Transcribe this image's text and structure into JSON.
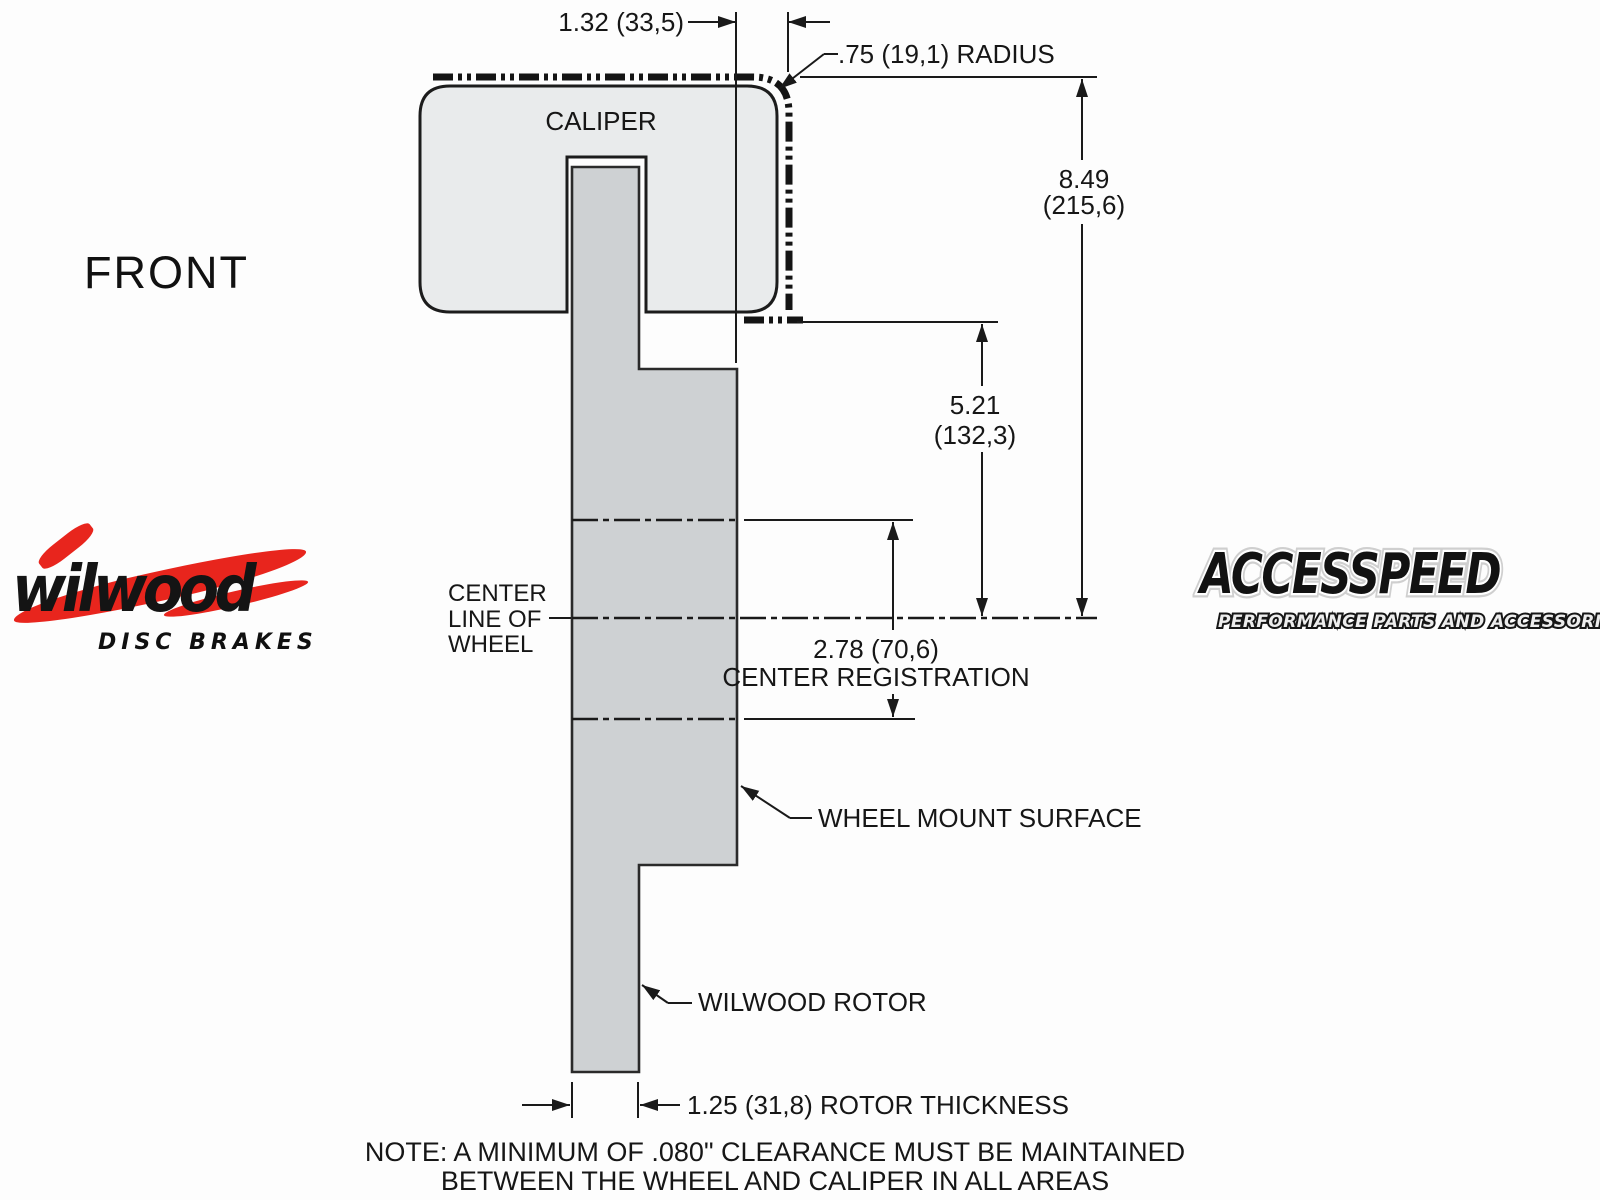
{
  "view": {
    "orientation_label": "FRONT"
  },
  "labels": {
    "caliper": "CALIPER",
    "center_line": [
      "CENTER",
      "LINE OF",
      "WHEEL"
    ],
    "wheel_mount_surface": "WHEEL MOUNT SURFACE",
    "wilwood_rotor": "WILWOOD ROTOR"
  },
  "dimensions": {
    "caliper_overhang": "1.32 (33,5)",
    "radius": ".75 (19,1) RADIUS",
    "overall_height_in": "8.49",
    "overall_height_mm": "(215,6)",
    "mount_height_in": "5.21",
    "mount_height_mm": "(132,3)",
    "center_registration_value": "2.78 (70,6)",
    "center_registration_label": "CENTER REGISTRATION",
    "rotor_thickness": "1.25 (31,8) ROTOR THICKNESS"
  },
  "note": {
    "line1": "NOTE: A MINIMUM OF .080\" CLEARANCE MUST BE MAINTAINED",
    "line2": "BETWEEN THE WHEEL AND CALIPER IN ALL AREAS"
  },
  "logos": {
    "wilwood": {
      "name": "wilwood",
      "tagline": "DISC BRAKES",
      "red": "#e8251d"
    },
    "accesspeed": {
      "name": "ACCESSPEED",
      "tagline": "PERFORMANCE PARTS AND ACCESSORIES"
    }
  },
  "colors": {
    "line": "#1a1a1a",
    "caliper_fill": "#e9ebec",
    "rotor_fill": "#ced1d3",
    "wilwood_red": "#e8251d"
  }
}
